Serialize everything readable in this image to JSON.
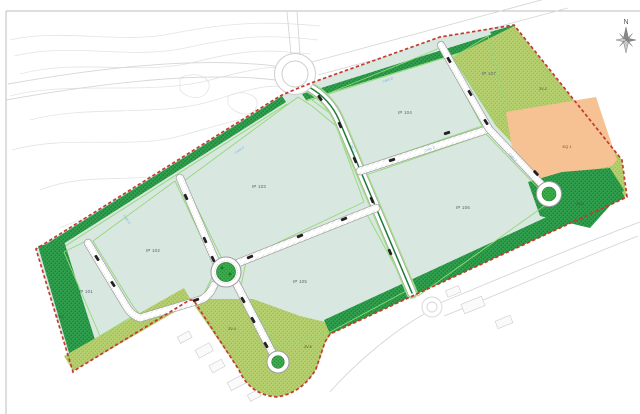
{
  "labels": {
    "compass": "N",
    "parcels": [
      "IP 101",
      "IP 102",
      "IP 103",
      "IP 104",
      "IP 105",
      "IP 106",
      "IP 107"
    ],
    "equipment": "EQ 1",
    "green_zones": [
      "ZV-1",
      "ZV-2",
      "ZV-3",
      "ZV-4",
      "ZV-5"
    ],
    "streets": [
      "Calle A",
      "Calle B",
      "Calle C",
      "Calle D",
      "Calle E",
      "Calle F"
    ]
  },
  "colors": {
    "site_fill": "#d9e7e1",
    "dark_green": "#2f9e4d",
    "olive_green": "#b6cf6f",
    "orange_parcel": "#f6c193",
    "boundary_red": "#c23b2e",
    "road_fill": "#ffffff",
    "road_casing": "#9f9f9f",
    "median_green": "#1f7a38",
    "verge_green": "#8ed973",
    "roundabout_green": "#3cae4c"
  }
}
